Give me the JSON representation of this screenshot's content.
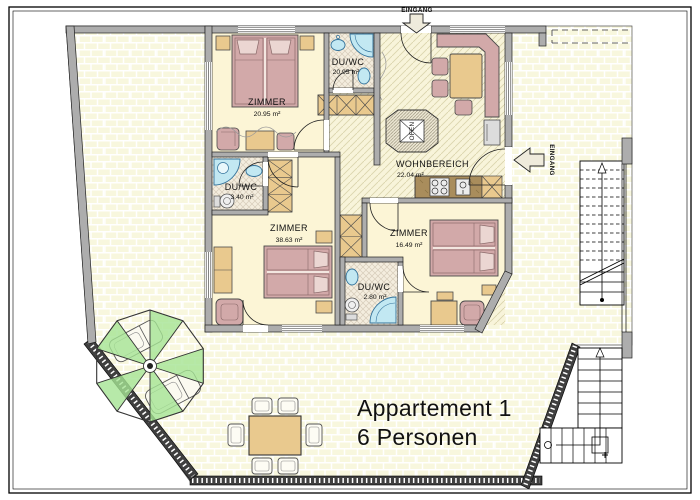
{
  "plan": {
    "title_line1": "Appartement 1",
    "title_line2": "6 Personen",
    "entrances": {
      "top": "EINGANG",
      "side": "EINGANG"
    },
    "stove_label": "OFEN",
    "rooms": {
      "zimmer1": {
        "name": "ZIMMER",
        "area": "20.95 m²"
      },
      "duwc1": {
        "name": "DU/WC",
        "area": "20.95 m²"
      },
      "wohnbereich": {
        "name": "WOHNBEREICH",
        "area": "22.04 m²"
      },
      "duwc2": {
        "name": "DU/WC",
        "area": "3.40 m²"
      },
      "zimmer2": {
        "name": "ZIMMER",
        "area": "38.63 m²"
      },
      "duwc3": {
        "name": "DU/WC",
        "area": "2.80 m²"
      },
      "zimmer3": {
        "name": "ZIMMER",
        "area": "16.49 m²"
      }
    },
    "colors": {
      "wall": "#ADADAD",
      "room_floor": "#FCF5D6",
      "brick": "#F8F7DE",
      "furniture_pink": "#D2A9A9",
      "furniture_tan": "#E9C98E",
      "fixture_blue": "#C2E8F2",
      "parasol_green": "#A5E394",
      "kitchen_brown": "#A98D5C"
    }
  }
}
